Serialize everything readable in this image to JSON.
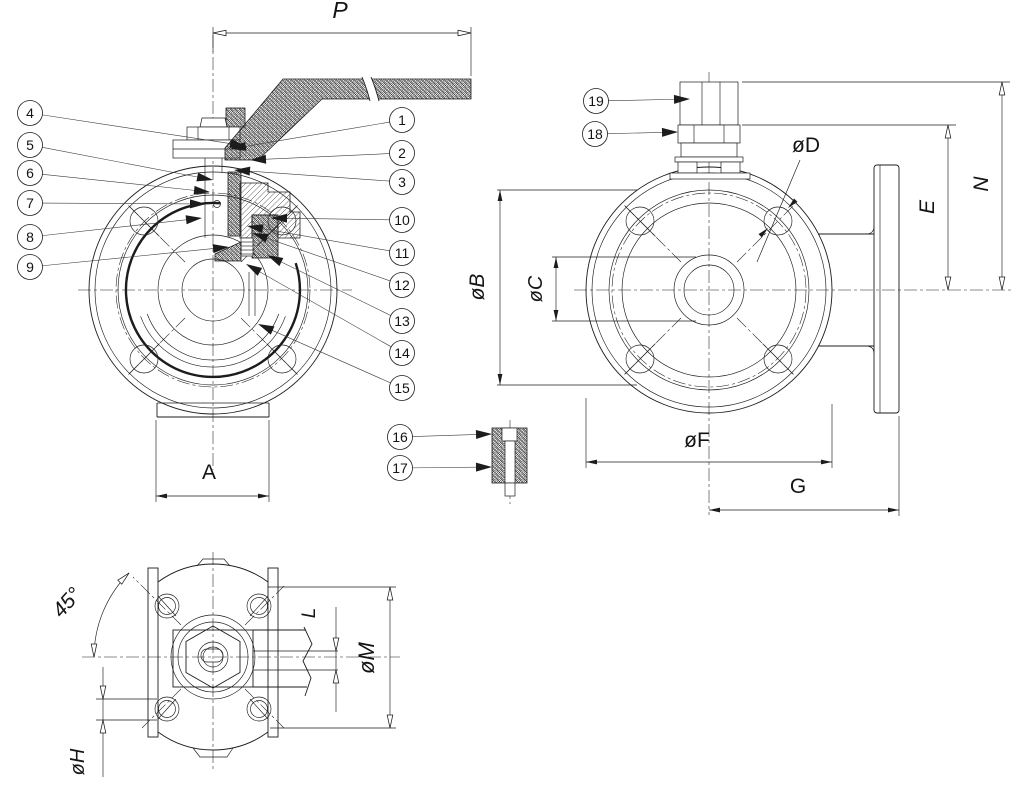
{
  "colors": {
    "line": "#1c1c1c",
    "background": "#ffffff",
    "text": "#141414"
  },
  "callouts": [
    {
      "label": "1",
      "cx": 402,
      "cy": 120,
      "tx": 230,
      "ty": 149
    },
    {
      "label": "2",
      "cx": 402,
      "cy": 153,
      "tx": 250,
      "ty": 160
    },
    {
      "label": "3",
      "cx": 402,
      "cy": 182,
      "tx": 234,
      "ty": 170
    },
    {
      "label": "4",
      "cx": 30,
      "cy": 113,
      "tx": 246,
      "ty": 146
    },
    {
      "label": "5",
      "cx": 30,
      "cy": 145,
      "tx": 213,
      "ty": 180
    },
    {
      "label": "6",
      "cx": 30,
      "cy": 173,
      "tx": 210,
      "ty": 192
    },
    {
      "label": "7",
      "cx": 30,
      "cy": 203,
      "tx": 206,
      "ty": 204
    },
    {
      "label": "8",
      "cx": 30,
      "cy": 237,
      "tx": 202,
      "ty": 218
    },
    {
      "label": "9",
      "cx": 30,
      "cy": 267,
      "tx": 229,
      "ty": 247
    },
    {
      "label": "10",
      "cx": 402,
      "cy": 220,
      "tx": 271,
      "ty": 218
    },
    {
      "label": "11",
      "cx": 402,
      "cy": 253,
      "tx": 247,
      "ty": 226
    },
    {
      "label": "12",
      "cx": 402,
      "cy": 285,
      "tx": 252,
      "ty": 233
    },
    {
      "label": "13",
      "cx": 402,
      "cy": 321,
      "tx": 267,
      "ty": 255
    },
    {
      "label": "14",
      "cx": 402,
      "cy": 353,
      "tx": 246,
      "ty": 264
    },
    {
      "label": "15",
      "cx": 402,
      "cy": 388,
      "tx": 258,
      "ty": 324
    },
    {
      "label": "16",
      "cx": 400,
      "cy": 437,
      "tx": 492,
      "ty": 434
    },
    {
      "label": "17",
      "cx": 400,
      "cy": 468,
      "tx": 492,
      "ty": 467
    },
    {
      "label": "18",
      "cx": 595,
      "cy": 134,
      "tx": 678,
      "ty": 132
    },
    {
      "label": "19",
      "cx": 596,
      "cy": 101,
      "tx": 690,
      "ty": 99
    }
  ],
  "dim_labels": [
    {
      "label": "P",
      "x": 340,
      "y": 18,
      "rot": 0,
      "italic": true,
      "size": 23
    },
    {
      "label": "øB",
      "x": 484,
      "y": 287,
      "rot": -90,
      "italic": true,
      "size": 21
    },
    {
      "label": "øC",
      "x": 542,
      "y": 289,
      "rot": -90,
      "italic": true,
      "size": 20
    },
    {
      "label": "A",
      "x": 209,
      "y": 479,
      "rot": 0,
      "italic": false,
      "size": 21
    },
    {
      "label": "øD",
      "x": 806,
      "y": 152,
      "rot": 0,
      "italic": false,
      "size": 21
    },
    {
      "label": "E",
      "x": 934,
      "y": 207,
      "rot": -90,
      "italic": true,
      "size": 21
    },
    {
      "label": "N",
      "x": 988,
      "y": 184,
      "rot": -90,
      "italic": true,
      "size": 21
    },
    {
      "label": "øF",
      "x": 697,
      "y": 447,
      "rot": 0,
      "italic": false,
      "size": 21
    },
    {
      "label": "G",
      "x": 798,
      "y": 493,
      "rot": 0,
      "italic": false,
      "size": 21
    },
    {
      "label": "45°",
      "x": 72,
      "y": 607,
      "rot": -48,
      "italic": true,
      "size": 21
    },
    {
      "label": "øH",
      "x": 84,
      "y": 762,
      "rot": -90,
      "italic": true,
      "size": 20
    },
    {
      "label": "L",
      "x": 315,
      "y": 613,
      "rot": -90,
      "italic": true,
      "size": 19
    },
    {
      "label": "øM",
      "x": 374,
      "y": 658,
      "rot": -90,
      "italic": true,
      "size": 22
    }
  ],
  "dim_arrows": [
    {
      "x": 213,
      "y": 33,
      "a": 180,
      "t": "o"
    },
    {
      "x": 471,
      "y": 33,
      "a": 0,
      "t": "o"
    },
    {
      "x": 500,
      "y": 190,
      "a": -90,
      "t": "f"
    },
    {
      "x": 500,
      "y": 385,
      "a": 90,
      "t": "f"
    },
    {
      "x": 556,
      "y": 257,
      "a": -90,
      "t": "f"
    },
    {
      "x": 556,
      "y": 321,
      "a": 90,
      "t": "f"
    },
    {
      "x": 156,
      "y": 496,
      "a": 180,
      "t": "f"
    },
    {
      "x": 269,
      "y": 496,
      "a": 0,
      "t": "f"
    },
    {
      "x": 586,
      "y": 462,
      "a": 180,
      "t": "f"
    },
    {
      "x": 832,
      "y": 462,
      "a": 0,
      "t": "f"
    },
    {
      "x": 709,
      "y": 510,
      "a": 180,
      "t": "f"
    },
    {
      "x": 899,
      "y": 510,
      "a": 0,
      "t": "f"
    },
    {
      "x": 948,
      "y": 125,
      "a": -90,
      "t": "o"
    },
    {
      "x": 948,
      "y": 290,
      "a": 90,
      "t": "o"
    },
    {
      "x": 1002,
      "y": 82,
      "a": -90,
      "t": "o"
    },
    {
      "x": 1002,
      "y": 290,
      "a": 90,
      "t": "o"
    },
    {
      "x": 390,
      "y": 587,
      "a": -90,
      "t": "o"
    },
    {
      "x": 390,
      "y": 728,
      "a": 90,
      "t": "o"
    },
    {
      "x": 336,
      "y": 651,
      "a": 90,
      "t": "o"
    },
    {
      "x": 336,
      "y": 670,
      "a": -90,
      "t": "o"
    },
    {
      "x": 103,
      "y": 699,
      "a": 90,
      "t": "o"
    },
    {
      "x": 103,
      "y": 720,
      "a": -90,
      "t": "o"
    },
    {
      "x": 129,
      "y": 573,
      "a": -45,
      "t": "o"
    },
    {
      "x": 94,
      "y": 657,
      "a": 90,
      "t": "o"
    },
    {
      "x": 788,
      "y": 208,
      "a": 135,
      "t": "f"
    },
    {
      "x": 768,
      "y": 228,
      "a": -45,
      "t": "f"
    }
  ]
}
